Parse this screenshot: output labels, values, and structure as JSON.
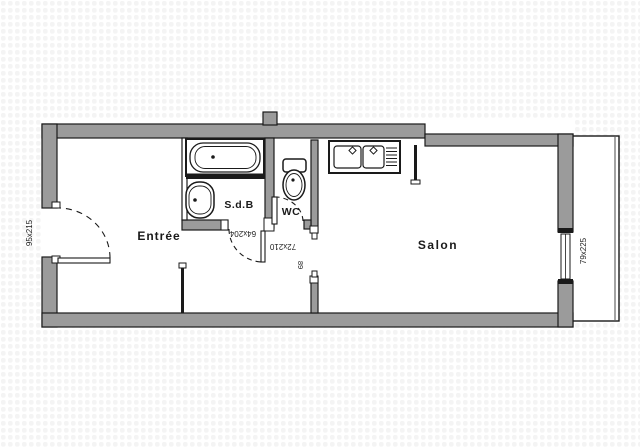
{
  "plan": {
    "type": "apartment-floor-plan",
    "rooms": [
      {
        "name": "entree",
        "label": "Entrée"
      },
      {
        "name": "salle-de-bain",
        "label": "S.d.B"
      },
      {
        "name": "wc",
        "label": "WC"
      },
      {
        "name": "salon",
        "label": "Salon"
      }
    ],
    "dimension_labels": [
      {
        "name": "entry-door-size",
        "label": "95x215"
      },
      {
        "name": "sdb-door-size",
        "label": "64x204"
      },
      {
        "name": "wc-door-size",
        "label": "72x210"
      },
      {
        "name": "salon-opening-width",
        "label": "89"
      },
      {
        "name": "salon-window-size",
        "label": "79x225"
      }
    ],
    "fixtures": [
      "bathtub",
      "washbasin",
      "toilet",
      "kitchen-sink",
      "balcony"
    ],
    "colors": {
      "wall_fill": "#9b9b9b",
      "line": "#1a1a1a",
      "background": "#ffffff",
      "dot_grid": "#f4f4f4"
    }
  }
}
